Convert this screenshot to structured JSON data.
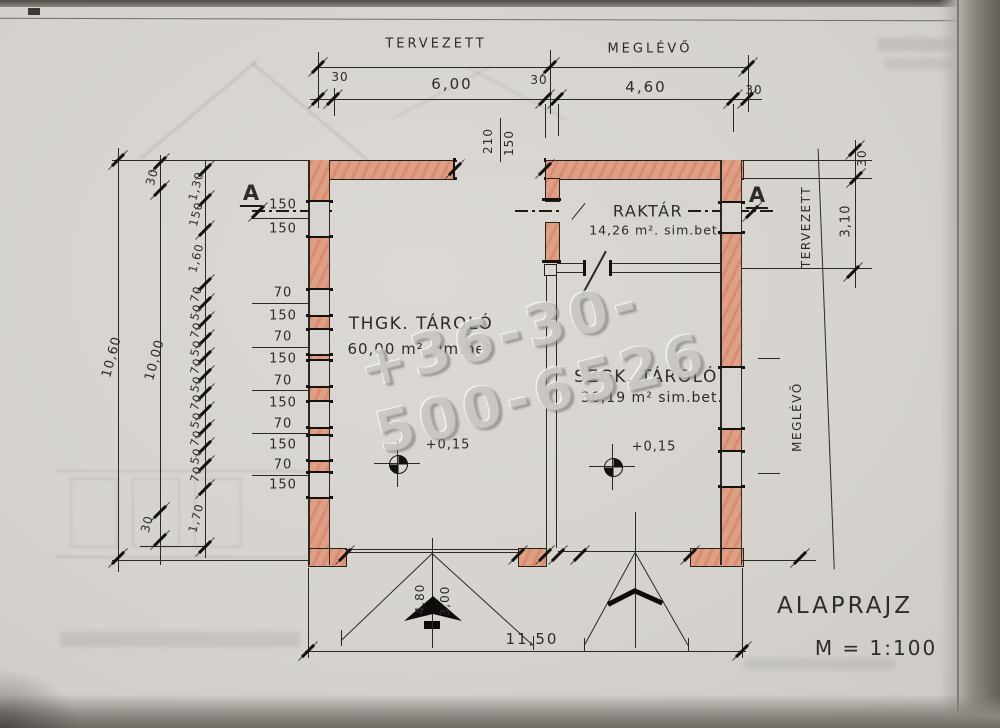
{
  "sheet": {
    "title": "ALAPRAJZ",
    "scale": "M = 1:100"
  },
  "watermark": "+36-30-500-6526",
  "top_dimensions": {
    "tervezett": "TERVEZETT",
    "meglevo": "MEGLÉVŐ",
    "wall_left": "30",
    "span_new": "6,00",
    "wall_mid": "30",
    "span_old": "4,60",
    "wall_right": "30",
    "lintel_a": "210",
    "lintel_b": "150"
  },
  "left_dimensions": {
    "total": "10,60",
    "inner_total": "10,00",
    "top_wall": "30",
    "bottom_wall": "30",
    "bottom_pier": "1,70",
    "chain": [
      "1,30",
      "150",
      "1,60",
      "70",
      "50",
      "70",
      "50",
      "70",
      "50",
      "70",
      "50",
      "70",
      "50",
      "70",
      "1,70"
    ],
    "window_chain": [
      "150",
      "150",
      "70",
      "150",
      "70",
      "150",
      "70",
      "150",
      "70",
      "150",
      "70",
      "150"
    ]
  },
  "right_dimensions": {
    "tervezett": "TERVEZETT",
    "meglevo": "MEGLÉVŐ",
    "wall": "30",
    "span": "3,10"
  },
  "bottom_dimensions": {
    "total": "11,50",
    "gate_width": "4,80",
    "gate_height": "3,00"
  },
  "section": {
    "label_left": "A",
    "label_right": "A"
  },
  "rooms": {
    "thgk": {
      "name": "THGK. TÁROLÓ",
      "area": "60,00 m² sim.bet",
      "level": "+0,15"
    },
    "szgk": {
      "name": "SZGK. TÁROLÓ",
      "area": "36,19 m² sim.bet.",
      "level": "+0,15"
    },
    "raktar": {
      "name": "RAKTÁR",
      "area": "14,26 m². sim.bet."
    }
  }
}
